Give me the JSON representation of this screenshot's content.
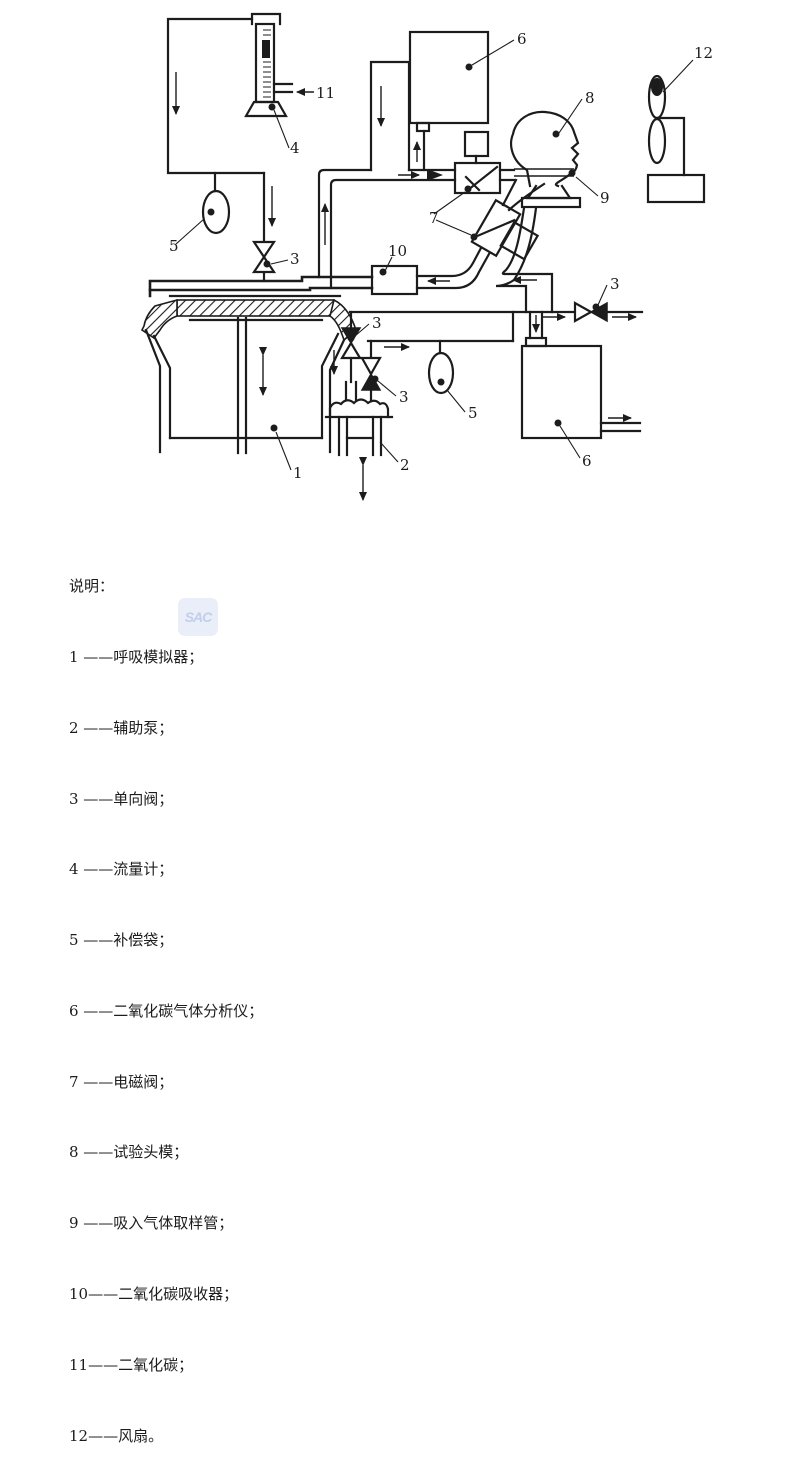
{
  "page": {
    "background": "#ffffff",
    "ink": "#1c1c1c"
  },
  "watermark": {
    "text": "SAC"
  },
  "diagram": {
    "description": "breathing-apparatus-test-schematic",
    "callouts": {
      "c1": "1",
      "c2": "2",
      "c3": "3",
      "c4": "4",
      "c5": "5",
      "c6": "6",
      "c7": "7",
      "c8": "8",
      "c9": "9",
      "c10": "10",
      "c11": "11",
      "c12": "12"
    }
  },
  "legend": {
    "header": "说明：",
    "items": [
      "1 ——呼吸模拟器；",
      "2 ——辅助泵；",
      "3 ——单向阀；",
      "4 ——流量计；",
      "5 ——补偿袋；",
      "6 ——二氧化碳气体分析仪；",
      "7 ——电磁阀；",
      "8 ——试验头模；",
      "9 ——吸入气体取样管；",
      "10——二氧化碳吸收器；",
      "11——二氧化碳；",
      "12——风扇。"
    ]
  }
}
